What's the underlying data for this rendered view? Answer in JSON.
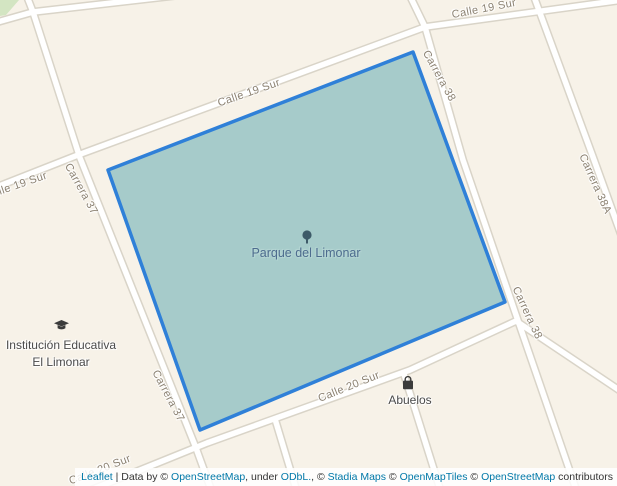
{
  "map": {
    "type": "leaflet-web-map",
    "selected_feature": "Parque del Limonar"
  },
  "streets": {
    "labels": [
      "Calle 19 Sur",
      "Calle 19 Sur",
      "Calle 19 Sur",
      "Carrera 37",
      "Carrera 37",
      "Carrera 38",
      "Carrera 38",
      "Carrera 38A",
      "Calle 20 Sur",
      "Calle 20 Sur"
    ]
  },
  "pois": {
    "park": {
      "name": "Parque del Limonar",
      "icon": "tree-icon"
    },
    "school": {
      "line1": "Institución Educativa",
      "line2": "El Limonar",
      "icon": "graduation-cap-icon"
    },
    "shop": {
      "name": "Abuelos",
      "icon": "shopping-bag-icon"
    }
  },
  "attribution": {
    "leaflet": "Leaflet",
    "sep": " | ",
    "data_by": "Data by © ",
    "osm1": "OpenStreetMap",
    "under": ", under ",
    "odbl": "ODbL.",
    "comma_c": ", © ",
    "stadia": "Stadia Maps",
    "c1": " © ",
    "openmaptiles": "OpenMapTiles",
    "c2": " © ",
    "osm2": "OpenStreetMap",
    "contributors": " contributors"
  },
  "colors": {
    "land": "#f7f2e8",
    "road_fill": "#ffffff",
    "road_casing": "#d9d4c8",
    "park_fill": "#a6cbca",
    "park_stroke": "#2f80d8",
    "green_area": "#d3e5c2",
    "street_label": "#8b8171",
    "park_label": "#4d6c8e",
    "poi_label": "#4a4a4a",
    "link": "#0078a8"
  }
}
